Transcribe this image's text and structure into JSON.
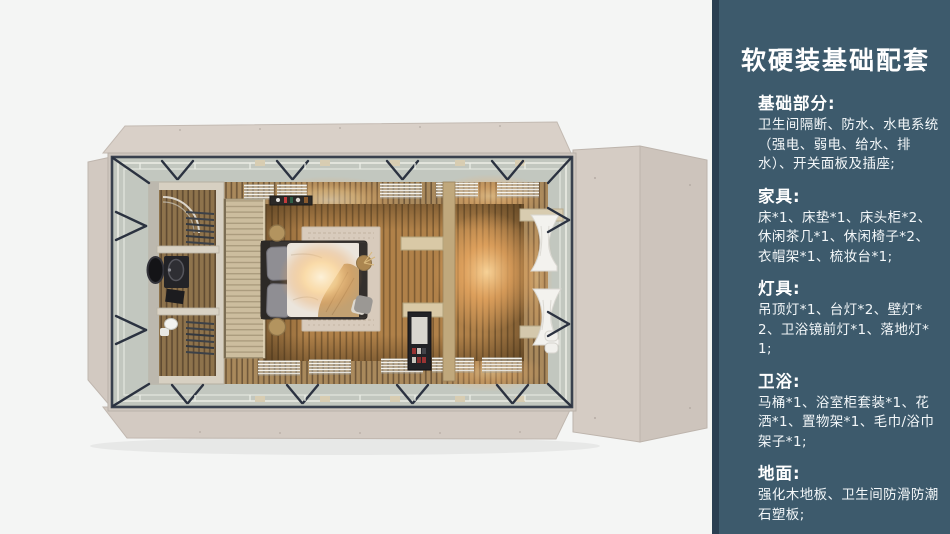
{
  "sidebar": {
    "title": "软硬装基础配套",
    "panel_color": "#3d5a6c",
    "edge_color": "#2a3f52",
    "text_color": "#ffffff",
    "sections": [
      {
        "heading": "基础部分:",
        "body": "卫生间隔断、防水、水电系统（强电、弱电、给水、排水）、开关面板及插座;"
      },
      {
        "heading": "家具:",
        "body": "床*1、床垫*1、床头柜*2、休闲茶几*1、休闲椅子*2、衣帽架*1、梳妆台*1;"
      },
      {
        "heading": "灯具:",
        "body": "吊顶灯*1、台灯*2、壁灯*2、卫浴镜前灯*1、落地灯*1;"
      },
      {
        "heading": "卫浴:",
        "body": "马桶*1、浴室柜套装*1、花洒*1、置物架*1、毛巾/浴巾架子*1;"
      },
      {
        "heading": "地面:",
        "body": "强化木地板、卫生间防滑防潮石塑板;"
      }
    ]
  },
  "render": {
    "subject": "container-home bedroom and bathroom, top-down 3D render",
    "palette": {
      "background": "#f4f5f4",
      "exterior_panels": "#d8cfc7",
      "steel_frame": "#39414e",
      "glass_band": "#c2c7bf",
      "wall_wood": "#a9895c",
      "floor_wood": "#b08149",
      "warm_light": "#ffd795",
      "bed_frame": "#3a3633",
      "duvet": "#ebe5dc",
      "curtain": "#f3f2ee"
    }
  }
}
